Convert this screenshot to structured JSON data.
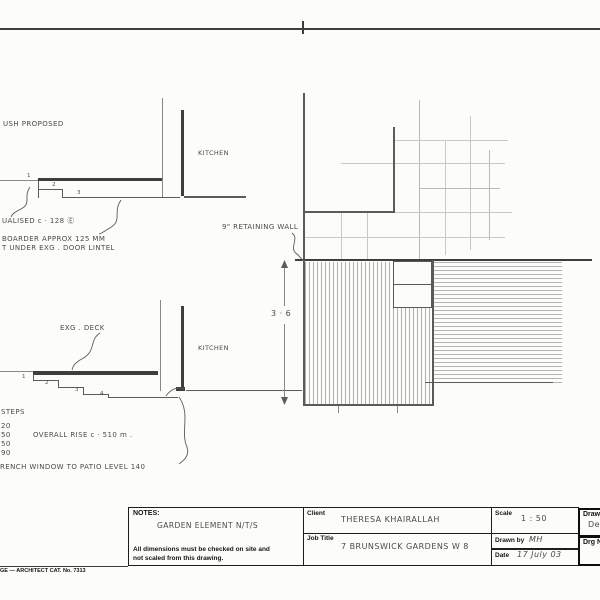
{
  "sheet": {
    "footer": "GE — ARCHITECT CAT. No. 7313"
  },
  "upper_detail": {
    "proposed_note": "USH  PROPOSED",
    "room_label": "KITCHEN",
    "steps": [
      "1",
      "2",
      "3"
    ],
    "ann_equalised": "UALISED    c · 128  Ⓔ",
    "ann_boarder": "BOARDER  APPROX    125 MM",
    "ann_lintel": "T UNDER   EXG . DOOR  LINTEL"
  },
  "lower_detail": {
    "deck_label": "EXG . DECK",
    "room_label": "KITCHEN",
    "steps": [
      "1",
      "2",
      "3",
      "4"
    ],
    "steps_heading": "STEPS",
    "risers": [
      "20",
      "50",
      "50",
      "90"
    ],
    "overall_rise": "OVERALL  RISE   c · 510 m .",
    "window_note": "RENCH  WINDOW  TO  PATIO  LEVEL  140"
  },
  "plan": {
    "wall_label": "9\"  RETAINING  WALL",
    "dim_value": "3 · 6"
  },
  "title_block": {
    "notes": {
      "label": "NOTES:",
      "content": "GARDEN  ELEMENT  N/T/S",
      "body1": "All dimensions must be checked on site and",
      "body2": "not scaled from this drawing."
    },
    "client": {
      "label": "Client",
      "value": "THERESA  KHAIRALLAH"
    },
    "job": {
      "label": "Job Title",
      "value": "7  BRUNSWICK  GARDENS   W 8"
    },
    "scale": {
      "label": "Scale",
      "value": "1 : 50"
    },
    "drawn": {
      "label": "Drawn by",
      "value": "MH"
    },
    "date": {
      "label": "Date",
      "value": "17 July 03"
    },
    "drawing": {
      "label": "Drawing",
      "value": "De"
    },
    "drg_no": {
      "label": "Drg No"
    }
  }
}
